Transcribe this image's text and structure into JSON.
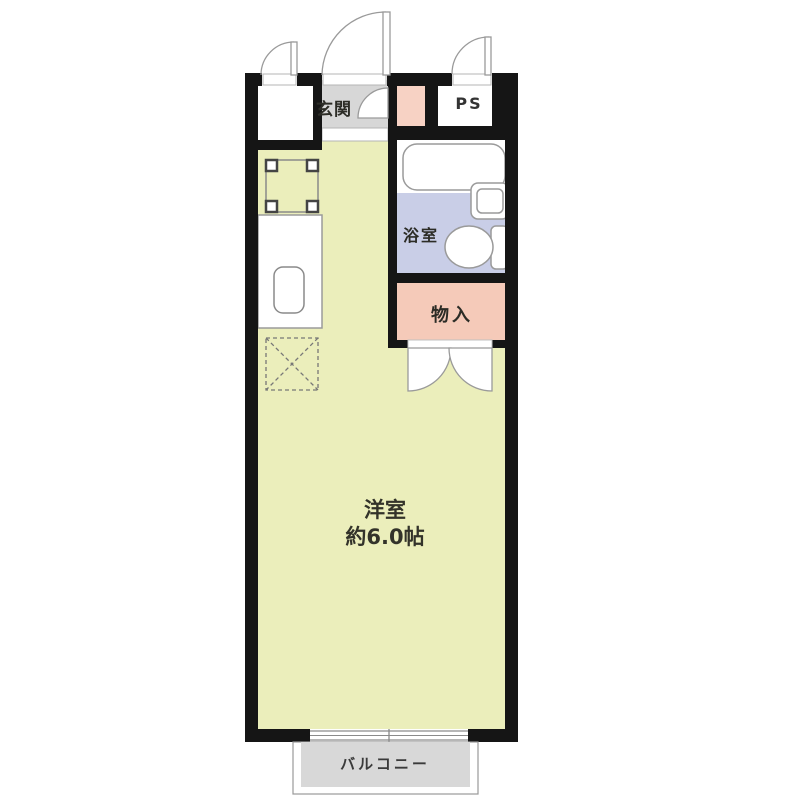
{
  "floorplan": {
    "rooms": {
      "entrance": {
        "label": "玄関",
        "color": "#d7d7d7"
      },
      "pipe_space": {
        "label": "PS",
        "color": "#ffffff"
      },
      "bathroom": {
        "label": "浴室",
        "color": "#c9cee7"
      },
      "storage": {
        "label": "物入",
        "color": "#f5cab9"
      },
      "shoe_cabinet": {
        "color": "#f7d2c4"
      },
      "main_room": {
        "label": "洋室",
        "size": "約6.0帖",
        "color": "#ebeebb"
      },
      "balcony": {
        "label": "バルコニー",
        "color": "#d8d8d8"
      }
    },
    "fixtures": [
      "bathtub",
      "wash-basin",
      "toilet",
      "gas-stove",
      "kitchen-counter",
      "kitchen-sink",
      "refrigerator-space",
      "front-door",
      "entrance-closet-door",
      "ps-door",
      "shoe-cabinet-door",
      "storage-double-doors",
      "sliding-window",
      "entry-step"
    ],
    "colors": {
      "wall": "#151515",
      "background": "#ffffff",
      "fixture_outline": "#9a9a9a",
      "threshold_outline": "#b5b5b5"
    }
  }
}
